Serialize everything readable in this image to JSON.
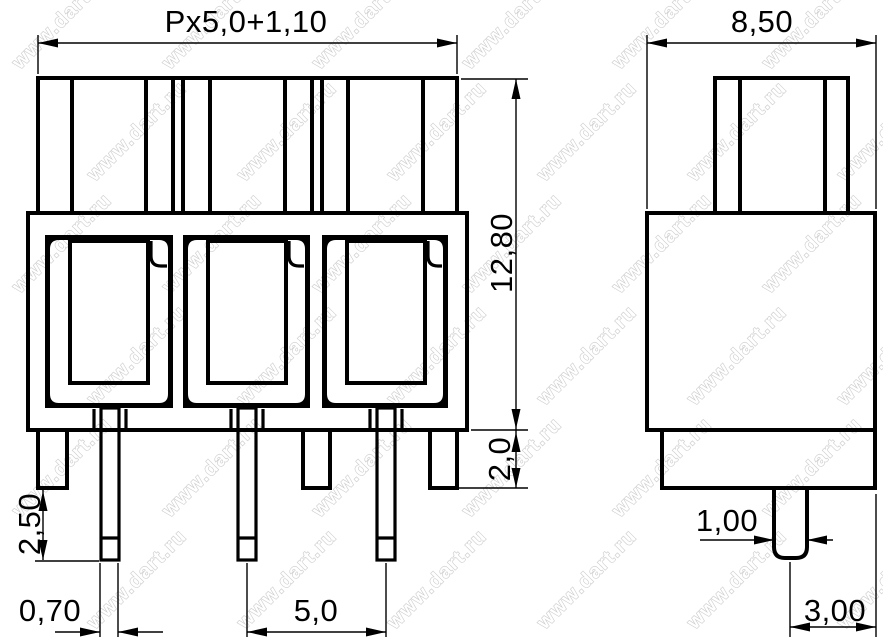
{
  "drawing": {
    "kind": "terminal-block-dimension-drawing",
    "colors": {
      "background": "#ffffff",
      "line": "#000000",
      "watermark": "#c9c9c9"
    },
    "watermark": {
      "text": "www.dart.ru"
    },
    "front_view": {
      "dim_total_width": "Px5,0+1,10",
      "dim_body_height": "12,80",
      "dim_base_height": "2,0",
      "dim_pin_protrusion": "2,50",
      "dim_pin_thickness": "0,70",
      "dim_pin_pitch": "5,0"
    },
    "side_view": {
      "dim_depth": "8,50",
      "dim_pin_width": "1,00",
      "dim_pin_to_edge": "3,00"
    }
  }
}
